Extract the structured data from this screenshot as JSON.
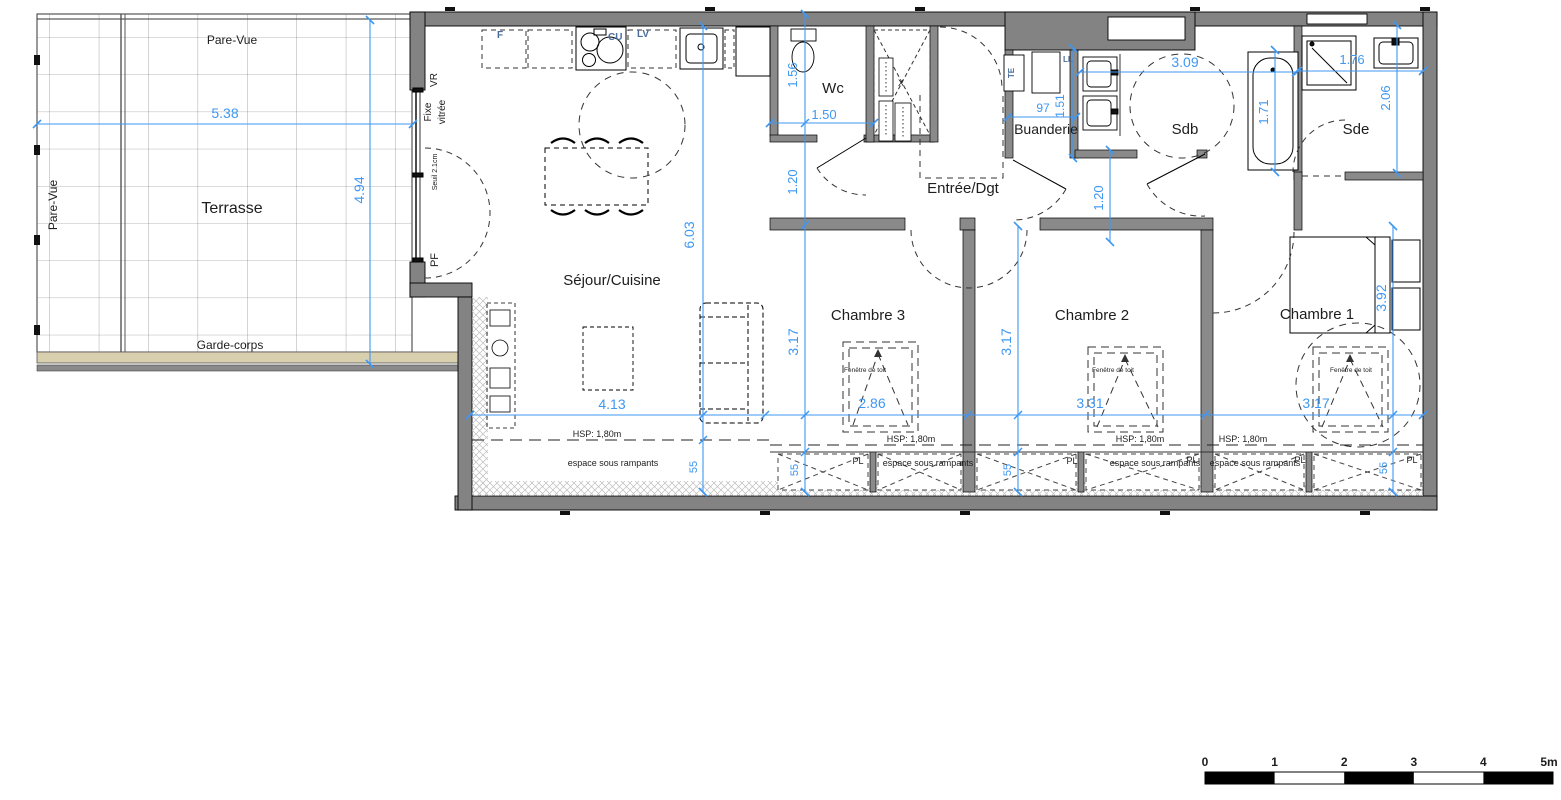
{
  "plan": {
    "rooms": {
      "terrasse": "Terrasse",
      "sejour_cuisine": "Séjour/Cuisine",
      "wc": "Wc",
      "entree_dgt": "Entrée/Dgt",
      "buanderie": "Buanderie",
      "sdb": "Sdb",
      "sde": "Sde",
      "chambre1": "Chambre 1",
      "chambre2": "Chambre 2",
      "chambre3": "Chambre 3"
    },
    "annotations": {
      "pare_vue": "Pare-Vue",
      "garde_corps": "Garde-corps",
      "vr": "VR",
      "fixe": "Fixe",
      "vitree": "vitrée",
      "seuil": "Seuil 2.1cm",
      "pf": "PF",
      "frigo": "F",
      "cuisson": "CU",
      "lave_vaisselle": "LV",
      "lave_linge": "LL",
      "tableau_electrique": "TE",
      "gaine": "X",
      "fenetre_de_toit": "Fenêtre de toit",
      "hsp": "HSP: 1,80m",
      "espace_sous_rampants": "espace sous rampants",
      "placard": "PL"
    },
    "dimensions": {
      "terrasse_largeur": "5.38",
      "terrasse_profondeur": "4.94",
      "sejour_longueur": "6.03",
      "sejour_largeur": "4.13",
      "wc_largeur": "1.50",
      "wc_profondeur": "1.56",
      "degagement": "1.20",
      "buanderie_largeur": "97",
      "buanderie_profondeur": "1.51",
      "sdb_largeur": "3.09",
      "sdb_profondeur": "1.71",
      "sde_largeur": "1.76",
      "sde_profondeur": "2.06",
      "chambre3_profondeur": "3.17",
      "chambre3_largeur": "2.86",
      "chambre2_profondeur": "3.17",
      "chambre2_largeur": "3.31",
      "chambre1_profondeur": "3.92",
      "chambre1_largeur": "3.17",
      "allege": "55"
    },
    "scale_bar": {
      "t0": "0",
      "t1": "1",
      "t2": "2",
      "t3": "3",
      "t4": "4",
      "t5": "5m"
    },
    "colors": {
      "wall": "#838383",
      "dimension": "#3E97F2",
      "room_label": "#1d1d1d",
      "accent_label": "#4179c4",
      "garde_corps_band": "#D8CFAF"
    }
  }
}
